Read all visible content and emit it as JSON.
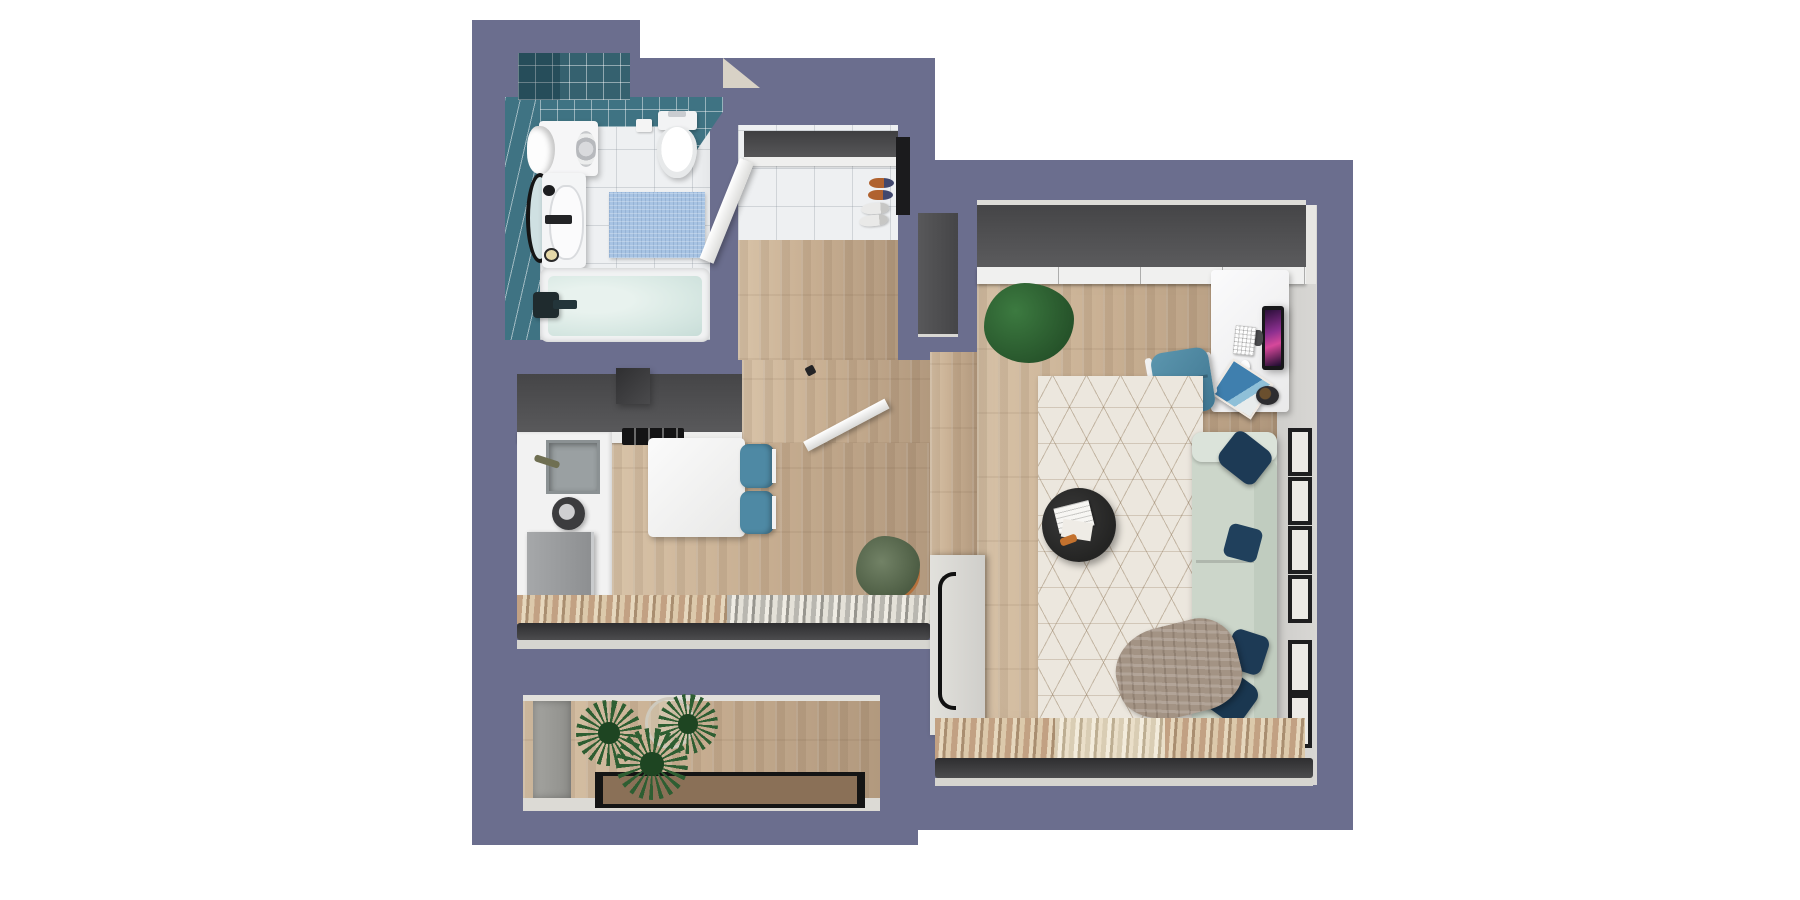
{
  "scene": {
    "kind": "3d-floor-plan-top-view-render",
    "apartment": "studio apartment",
    "rooms": [
      {
        "name": "bathroom",
        "objects": [
          "teal-tiled-walls",
          "shower-tile-block",
          "washing-machine",
          "towel",
          "toilet",
          "toilet-paper-holder",
          "round-mirror",
          "sink-vanity",
          "faucet",
          "soap-dish",
          "blue-bath-mat",
          "bathtub",
          "tub-faucet"
        ]
      },
      {
        "name": "entry-closet",
        "objects": [
          "shelf-band",
          "open-door",
          "slippers",
          "sneakers",
          "tile-floor",
          "wood-floor",
          "dark-niche"
        ]
      },
      {
        "name": "kitchen-hall",
        "objects": [
          "dark-counter",
          "range-hood",
          "cooktop",
          "kitchen-sink",
          "kettle",
          "fridge",
          "dining-table",
          "two-teal-chairs",
          "entry-door",
          "potted-shrub",
          "window-curtains"
        ]
      },
      {
        "name": "living-room",
        "objects": [
          "top-wardrobe",
          "ficus-plant",
          "desk",
          "monitor",
          "keyboard",
          "mouse",
          "magazine",
          "bowl",
          "desk-chair",
          "geometric-rug",
          "coffee-table",
          "papers",
          "sofa",
          "navy-pillows",
          "throw-blanket",
          "tall-wardrobe",
          "right-wall-windows",
          "window-curtains"
        ]
      },
      {
        "name": "balcony",
        "objects": [
          "wood-deck",
          "gray-mat",
          "spiky-plants",
          "glass-pot",
          "glass-railing"
        ]
      }
    ]
  },
  "colors": {
    "bg": "#ffffff",
    "wall": "#6b6e8e",
    "wood": "#c8af92",
    "woodLight": "#d8c3a8",
    "woodDark": "#b2997e",
    "tealTile": "#3f7383",
    "tealDark": "#35616f",
    "bathFloor": "#eef0f2",
    "water": "#d9e9e4",
    "matBlue": "#a7c3e3",
    "counterDark": "#4e4e50",
    "cabinetWhite": "#f2f2f2",
    "applianceGray": "#97999b",
    "chairTeal": "#4e89a4",
    "sofaSage": "#ccd6ca",
    "pillowNavy": "#1d3a55",
    "rugCream": "#ece7de",
    "wardrobeDark": "#4f4f51",
    "wardrobeLight": "#d7d6d1",
    "curtainTan": "#c2a183",
    "curtainCream": "#e6d7bd",
    "curtainGray": "#b9b7b0",
    "frameDark": "#3b3b3d",
    "sillLight": "#d6d5d0",
    "glassBrown": "#8a7057",
    "plantGreen": "#2e5e32",
    "plantDark": "#1e4522",
    "deskWhite": "#f5f5f6",
    "wallFace": "#d8d7d4",
    "doorWhite": "#fafafa",
    "beige": "#d8d2c6",
    "potOrange": "#b5713d",
    "screenA": "#8b2f8f",
    "screenB": "#d6489a",
    "slotBlack": "#1b1b1d",
    "magazineBlue": "#3f7fae"
  }
}
